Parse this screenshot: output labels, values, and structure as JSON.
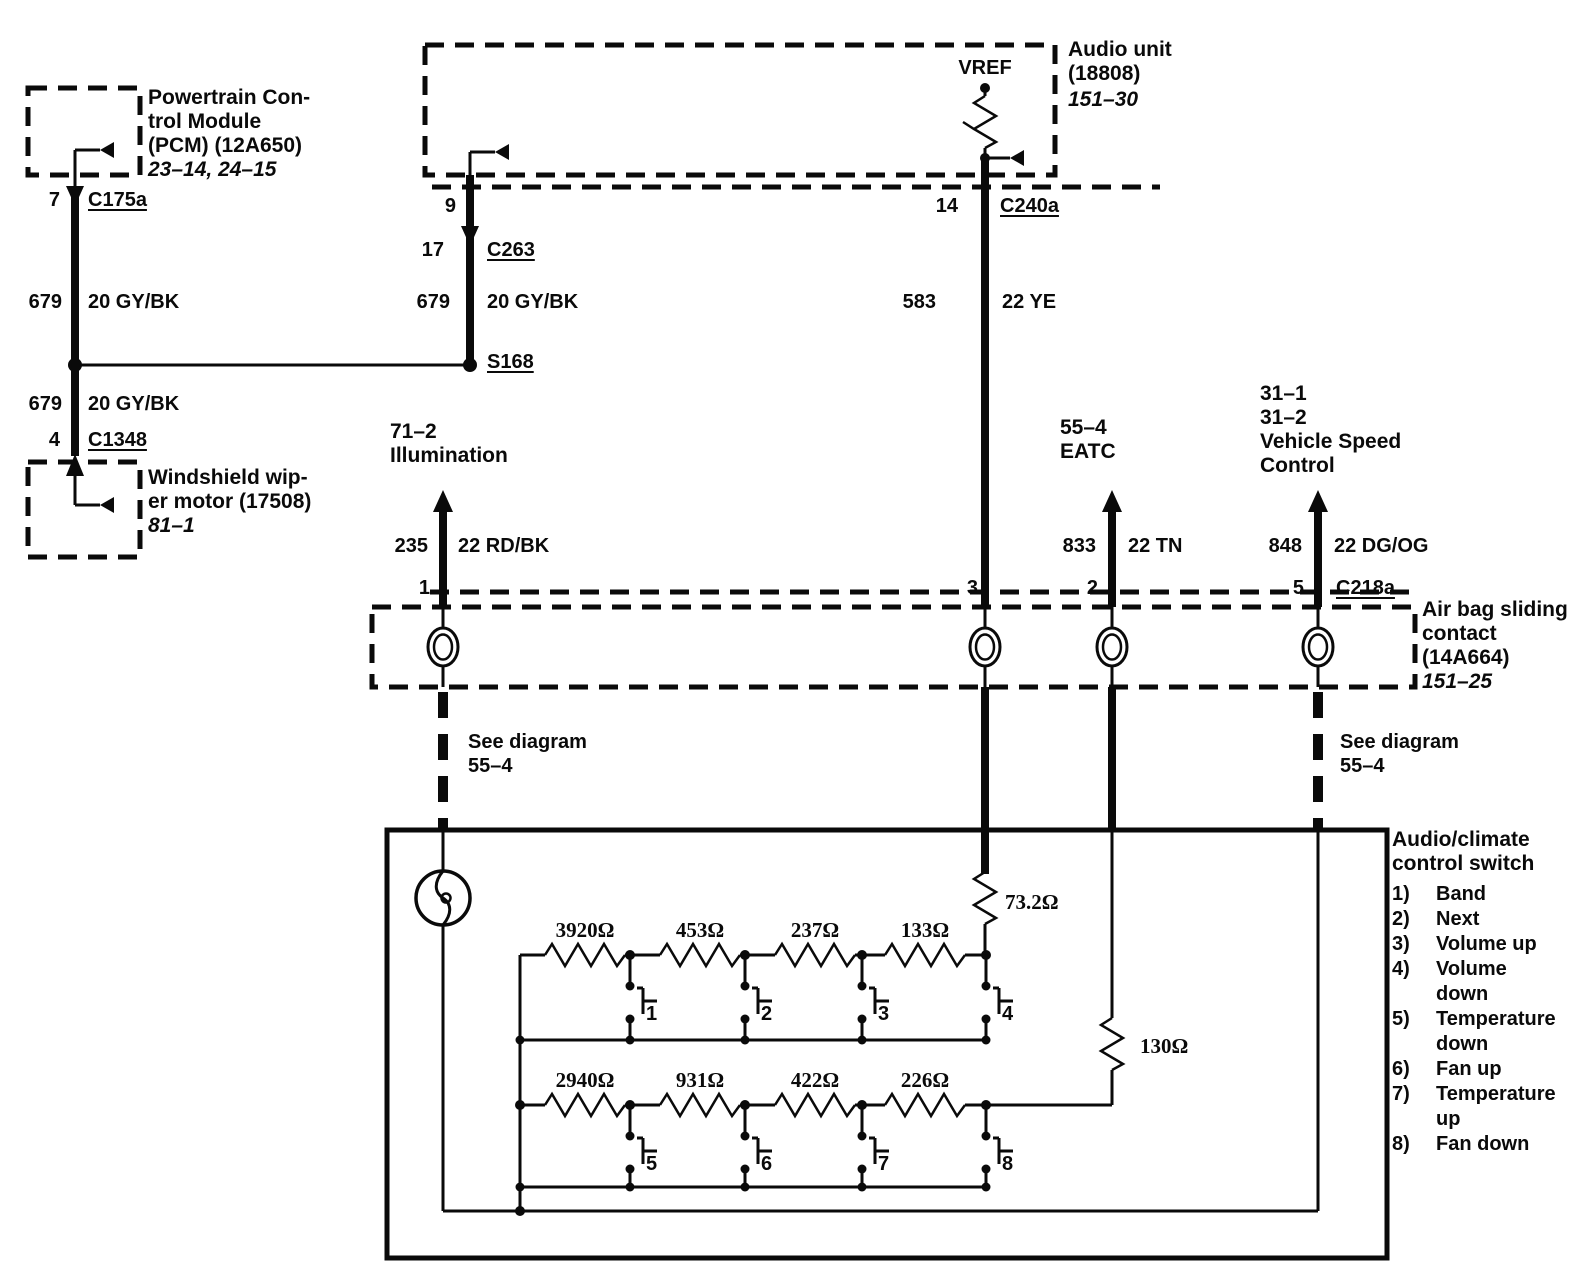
{
  "pcm": {
    "label": "Powertrain Con-\ntrol Module\n(PCM) (12A650)",
    "ref": "23–14, 24–15",
    "pin": "7",
    "connector": "C175a"
  },
  "wiper": {
    "label": "Windshield wip-\ner motor (17508)",
    "ref": "81–1",
    "pin": "4",
    "connector": "C1348"
  },
  "audio": {
    "label": "Audio unit\n(18808)",
    "ref": "151–30",
    "vref": "VREF",
    "pin9": "9",
    "pin17": "17",
    "c263": "C263",
    "splice": "S168",
    "pin14": "14",
    "c240a": "C240a"
  },
  "wires": {
    "w679a": {
      "circuit": "679",
      "gauge": "20 GY/BK"
    },
    "w679b": {
      "circuit": "679",
      "gauge": "20 GY/BK"
    },
    "w679c": {
      "circuit": "679",
      "gauge": "20 GY/BK"
    },
    "w583": {
      "circuit": "583",
      "gauge": "22 YE"
    },
    "w235": {
      "circuit": "235",
      "gauge": "22 RD/BK"
    },
    "w833": {
      "circuit": "833",
      "gauge": "22 TN"
    },
    "w848": {
      "circuit": "848",
      "gauge": "22 DG/OG"
    }
  },
  "dest": {
    "illumination": "71–2\nIllumination",
    "eatc": "55–4\nEATC",
    "vsc": "31–1\n31–2\nVehicle Speed\nControl"
  },
  "airbag": {
    "label": "Air bag sliding\ncontact\n(14A664)",
    "ref": "151–25",
    "pin1": "1",
    "pin3": "3",
    "pin2": "2",
    "pin5": "5",
    "connector": "C218a"
  },
  "see_left": "See diagram\n55–4",
  "see_right": "See diagram\n55–4",
  "acs": {
    "title": "Audio/climate\ncontrol switch",
    "legend": [
      {
        "n": "1)",
        "t": "Band"
      },
      {
        "n": "2)",
        "t": "Next"
      },
      {
        "n": "3)",
        "t": "Volume up"
      },
      {
        "n": "4)",
        "t": "Volume\ndown"
      },
      {
        "n": "5)",
        "t": "Temperature\ndown"
      },
      {
        "n": "6)",
        "t": "Fan up"
      },
      {
        "n": "7)",
        "t": "Temperature\nup"
      },
      {
        "n": "8)",
        "t": "Fan down"
      }
    ],
    "r_top": "73.2Ω",
    "r_mid": "130Ω",
    "row1": [
      "3920Ω",
      "453Ω",
      "237Ω",
      "133Ω"
    ],
    "row2": [
      "2940Ω",
      "931Ω",
      "422Ω",
      "226Ω"
    ],
    "sw1": [
      "1",
      "2",
      "3",
      "4"
    ],
    "sw2": [
      "5",
      "6",
      "7",
      "8"
    ]
  }
}
